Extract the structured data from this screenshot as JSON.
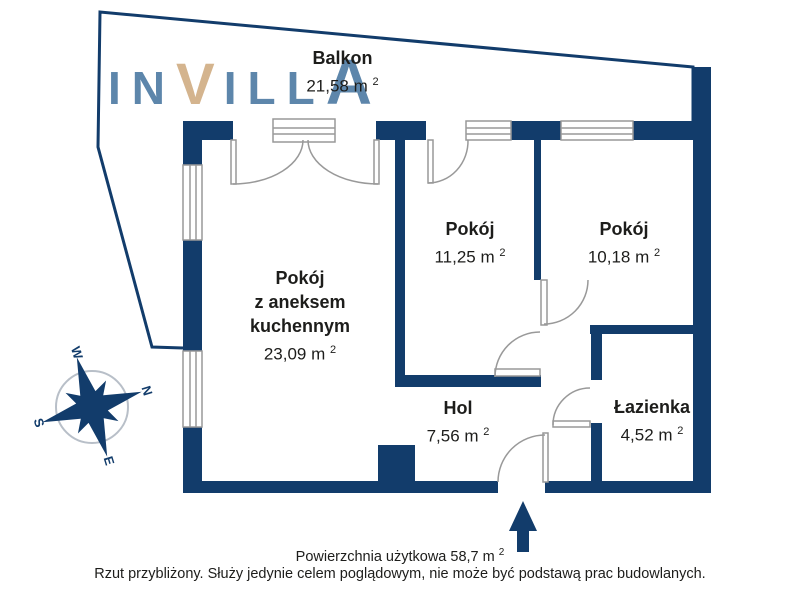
{
  "title": "Rzut mieszkania",
  "colors": {
    "wall": "#123c6b",
    "frame": "#999999",
    "text": "#1d1d1b",
    "logo_blue": "#5d86ab",
    "logo_tan": "#d4b48e",
    "compass_ring": "#b8bfc8"
  },
  "logo": {
    "text": "INVILLA",
    "letters": [
      "I",
      "N",
      "V",
      "I",
      "L",
      "L",
      "A"
    ]
  },
  "sup": "2",
  "rooms": {
    "balkon": {
      "name": "Balkon",
      "area": "21,58 m"
    },
    "living": {
      "name1": "Pokój",
      "name2": "z aneksem",
      "name3": "kuchennym",
      "area": "23,09 m"
    },
    "room1": {
      "name": "Pokój",
      "area": "11,25 m"
    },
    "room2": {
      "name": "Pokój",
      "area": "10,18 m"
    },
    "hol": {
      "name": "Hol",
      "area": "7,56 m"
    },
    "bath": {
      "name": "Łazienka",
      "area": "4,52 m"
    }
  },
  "compass": {
    "n": "N",
    "s": "S",
    "e": "E",
    "w": "W"
  },
  "footer": {
    "line1": "Powierzchnia użytkowa 58,7 m",
    "line2": "Rzut przybliżony. Służy jedynie celem poglądowym, nie może być podstawą prac budowlanych."
  }
}
